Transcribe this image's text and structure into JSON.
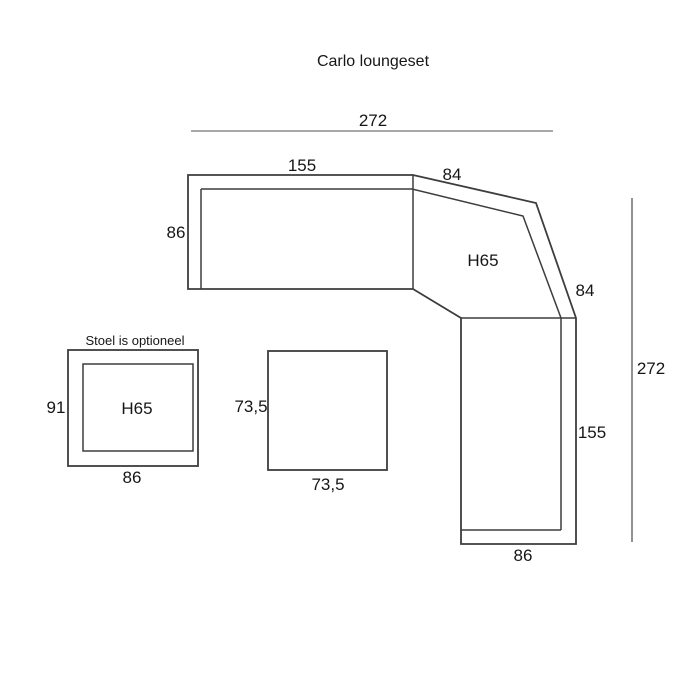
{
  "title": "Carlo loungeset",
  "colors": {
    "outline": "#3d3d3d",
    "dim_line_light": "#a8a8a8",
    "dim_line_dark": "#6f6f6f",
    "text": "#161616"
  },
  "sofa": {
    "dim_overall_width": "272",
    "dim_left_section_width": "155",
    "dim_corner_top_width": "84",
    "dim_left_depth": "86",
    "height_label": "H65",
    "dim_corner_right_width": "84",
    "dim_overall_height": "272",
    "dim_right_section_height": "155",
    "dim_bottom_depth": "86"
  },
  "chair": {
    "note": "Stoel is optioneel",
    "dim_depth": "91",
    "height_label": "H65",
    "dim_width": "86"
  },
  "table": {
    "dim_depth": "73,5",
    "dim_width": "73,5"
  }
}
